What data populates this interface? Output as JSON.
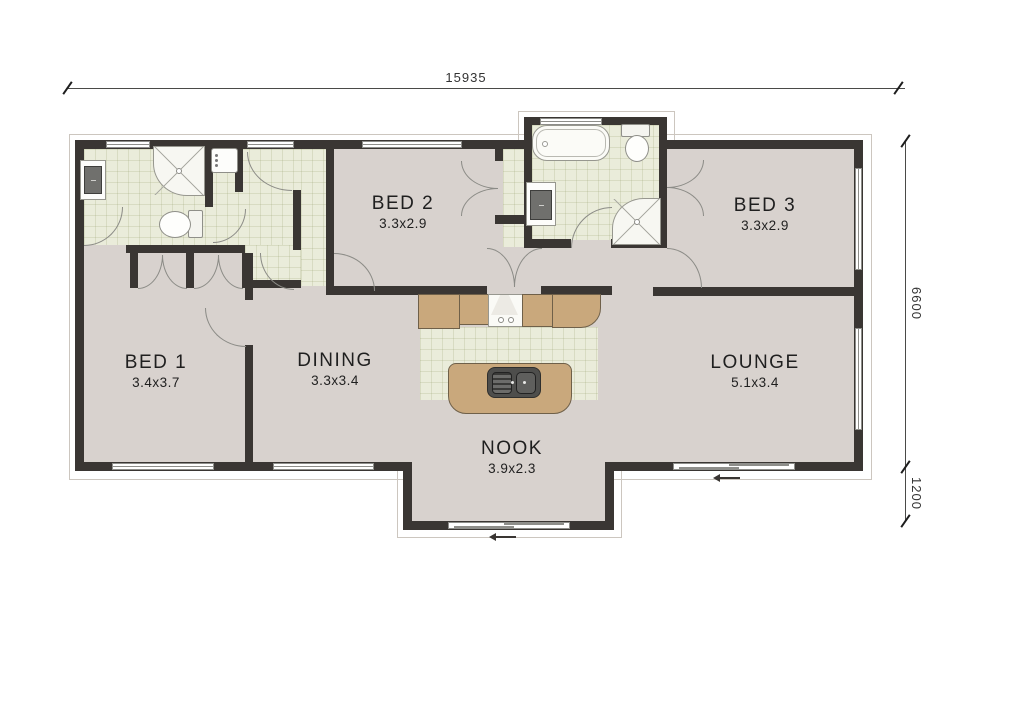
{
  "drawing": {
    "type": "residential floor plan"
  },
  "dimensions": {
    "width_total": "15935",
    "height_main": "6600",
    "nook_depth": "1200"
  },
  "rooms": {
    "bed1": {
      "label": "BED 1",
      "size": "3.4x3.7"
    },
    "bed2": {
      "label": "BED 2",
      "size": "3.3x2.9"
    },
    "bed3": {
      "label": "BED 3",
      "size": "3.3x2.9"
    },
    "dining": {
      "label": "DINING",
      "size": "3.3x3.4"
    },
    "lounge": {
      "label": "LOUNGE",
      "size": "5.1x3.4"
    },
    "nook": {
      "label": "NOOK",
      "size": "3.9x2.3"
    }
  },
  "fixtures": [
    "bathtub",
    "toilet",
    "corner-shower",
    "vanity-sink",
    "laundry-tub",
    "washing-machine",
    "kitchen-bench",
    "stove-rangehood",
    "island-bench",
    "double-sink",
    "wardrobe-doors",
    "hinged-doors",
    "sliding-doors",
    "windows"
  ],
  "colors": {
    "wall": "#3a3633",
    "carpet": "#d8d2ce",
    "tile": "#eaecda",
    "bench": "#c9a87c",
    "dimension_text": "#333333"
  }
}
